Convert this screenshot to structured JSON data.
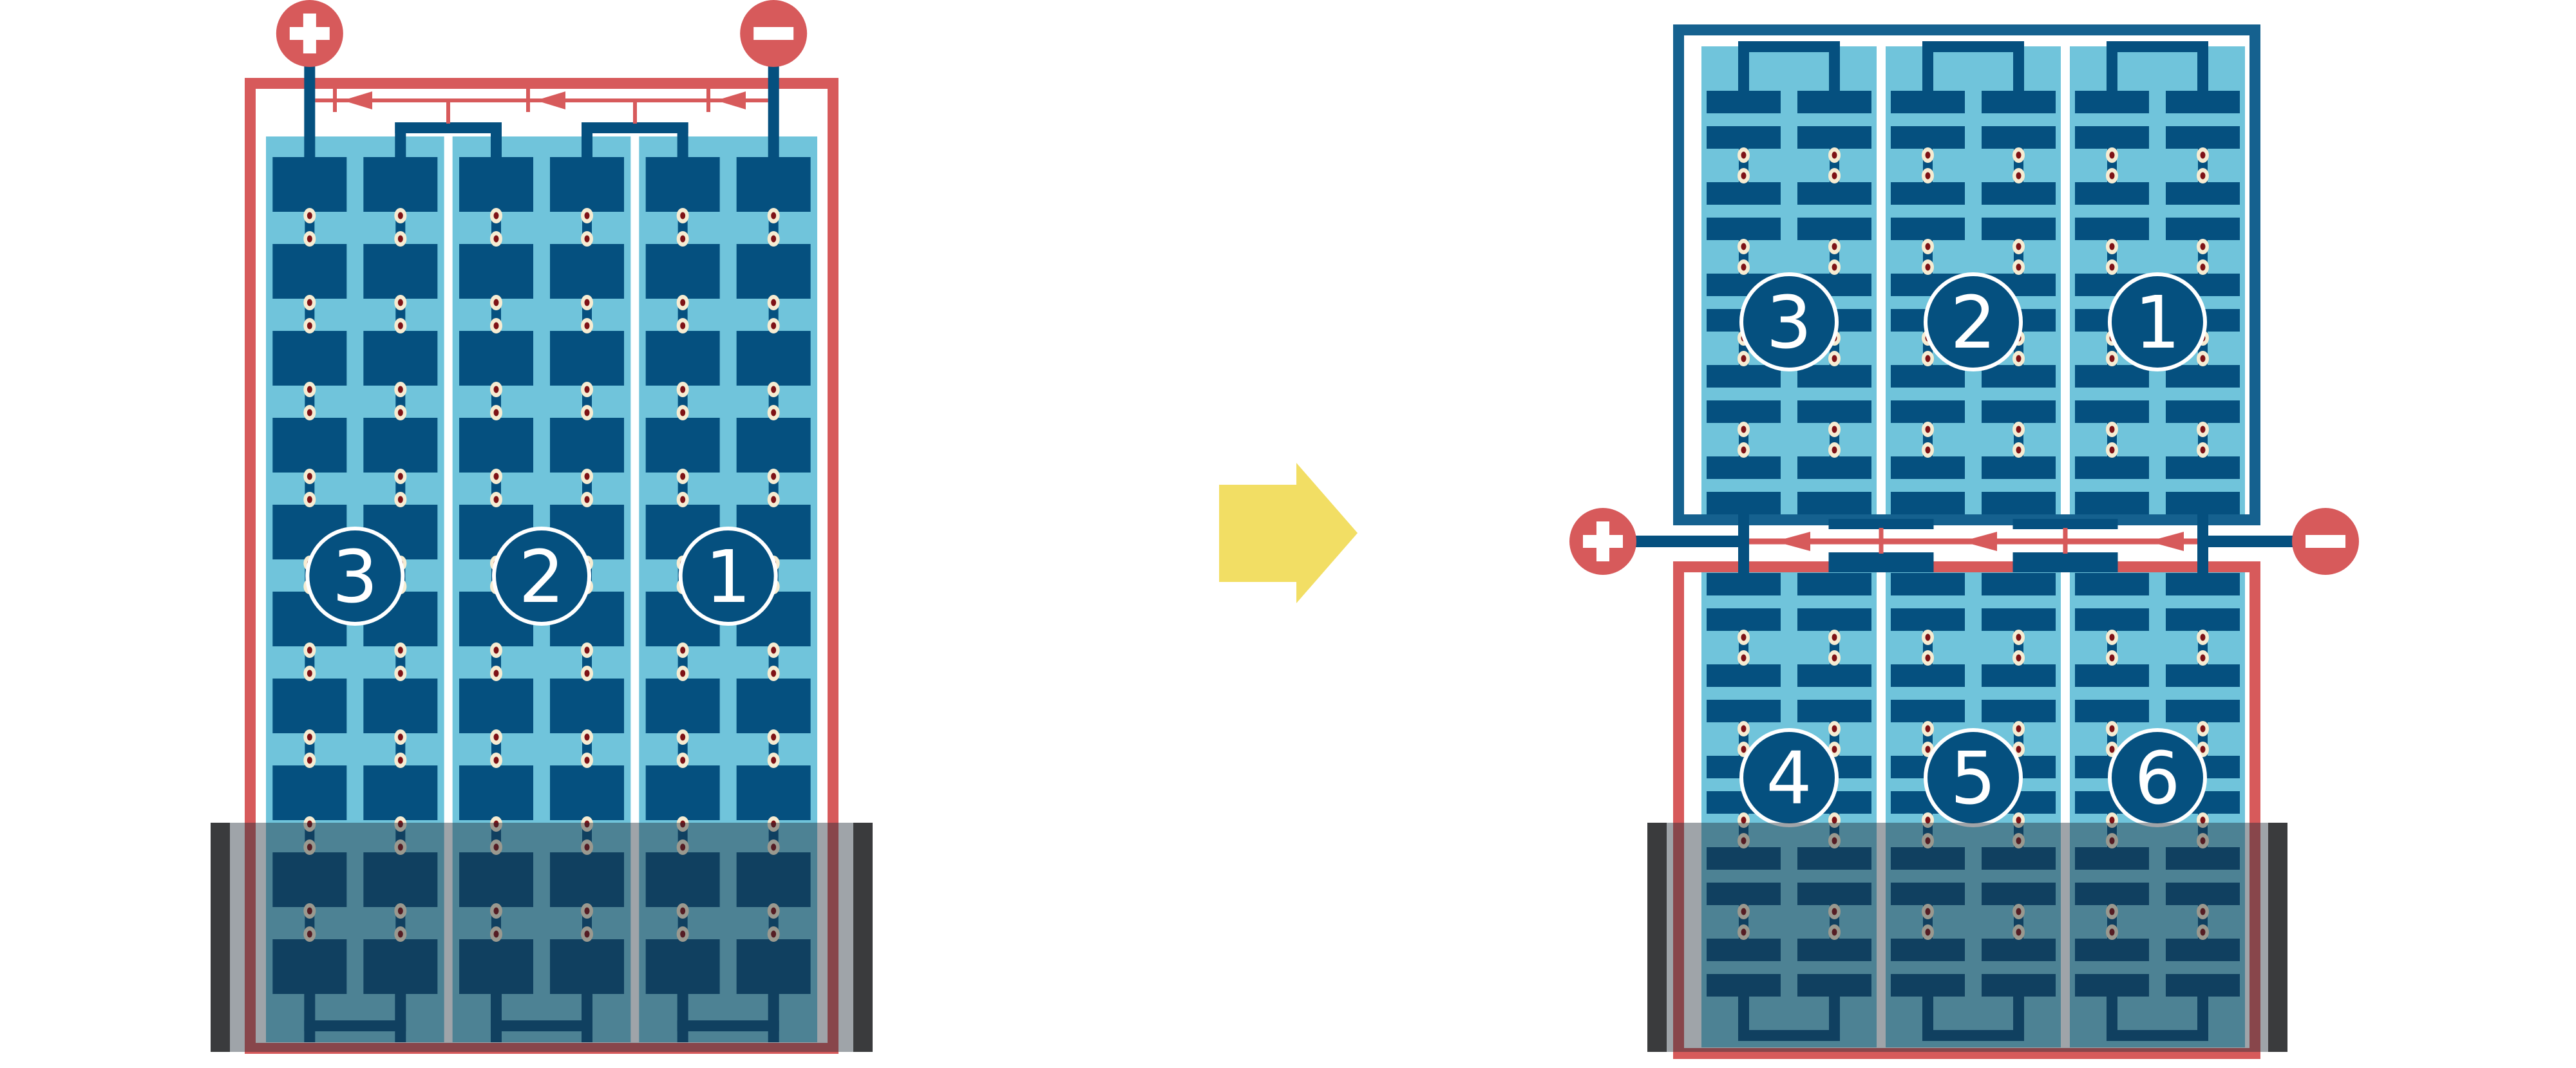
{
  "colors": {
    "red": "#d75a5b",
    "navy": "#05507f",
    "wire_navy": "#0a5181",
    "border_blue": "#15618f",
    "sky": "#70c4db",
    "cream": "#f6ecd2",
    "maroon": "#7e1216",
    "yellow": "#f2de64",
    "water": "rgba(32,45,56,0.43)",
    "edge_bar": "#3a3b3d",
    "white": "#ffffff"
  },
  "left_diagram": {
    "cell_labels": [
      "3",
      "2",
      "1"
    ],
    "terminal_positive": "+",
    "terminal_negative": "−"
  },
  "transform_arrow": {
    "direction": "right"
  },
  "right_diagram": {
    "top_unit_cell_labels": [
      "3",
      "2",
      "1"
    ],
    "bottom_unit_cell_labels": [
      "4",
      "5",
      "6"
    ],
    "terminal_positive": "+",
    "terminal_negative": "−"
  }
}
